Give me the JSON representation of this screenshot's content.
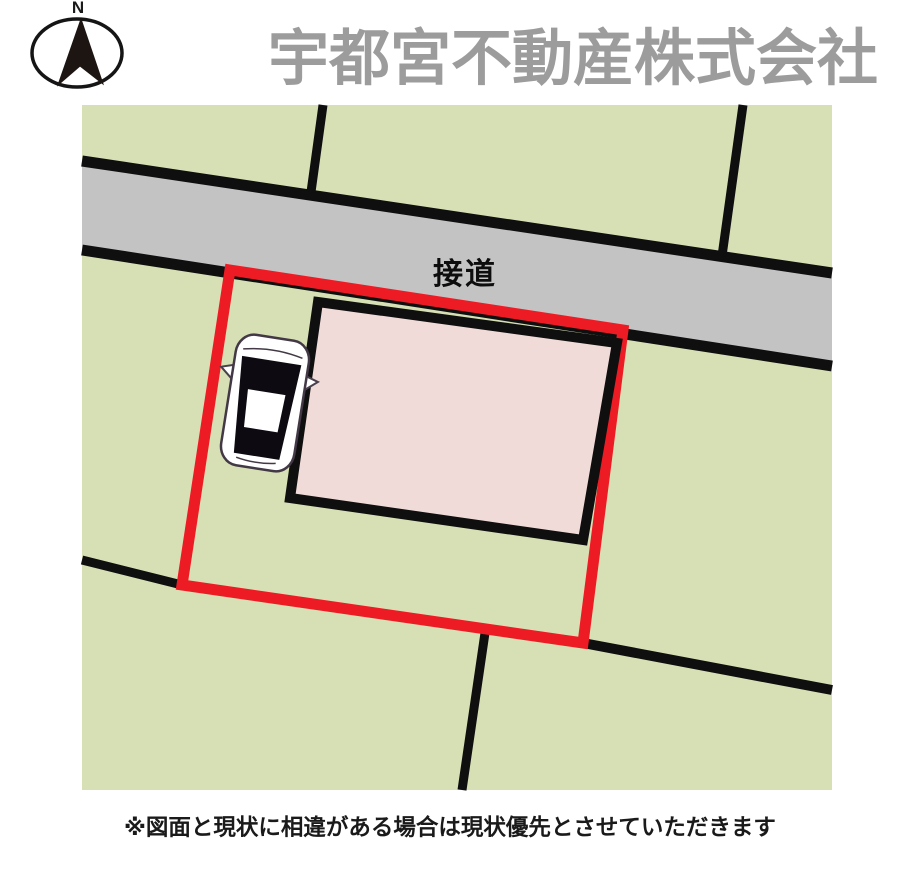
{
  "header": {
    "title": "宇都宮不動産株式会社",
    "compass_label": "N"
  },
  "map": {
    "road_label": "接道",
    "colors": {
      "parcel_green": "#d7e0b5",
      "road_gray": "#c3c3c3",
      "building_pink": "#f1dbd9",
      "boundary_red": "#ed1c24",
      "line_black": "#0f0f0f",
      "title_gray": "#9c9c9c",
      "car_body": "#ffffff",
      "car_glass": "#0d0a12"
    }
  },
  "footer": {
    "note": "※図面と現状に相違がある場合は現状優先とさせていただきます"
  }
}
